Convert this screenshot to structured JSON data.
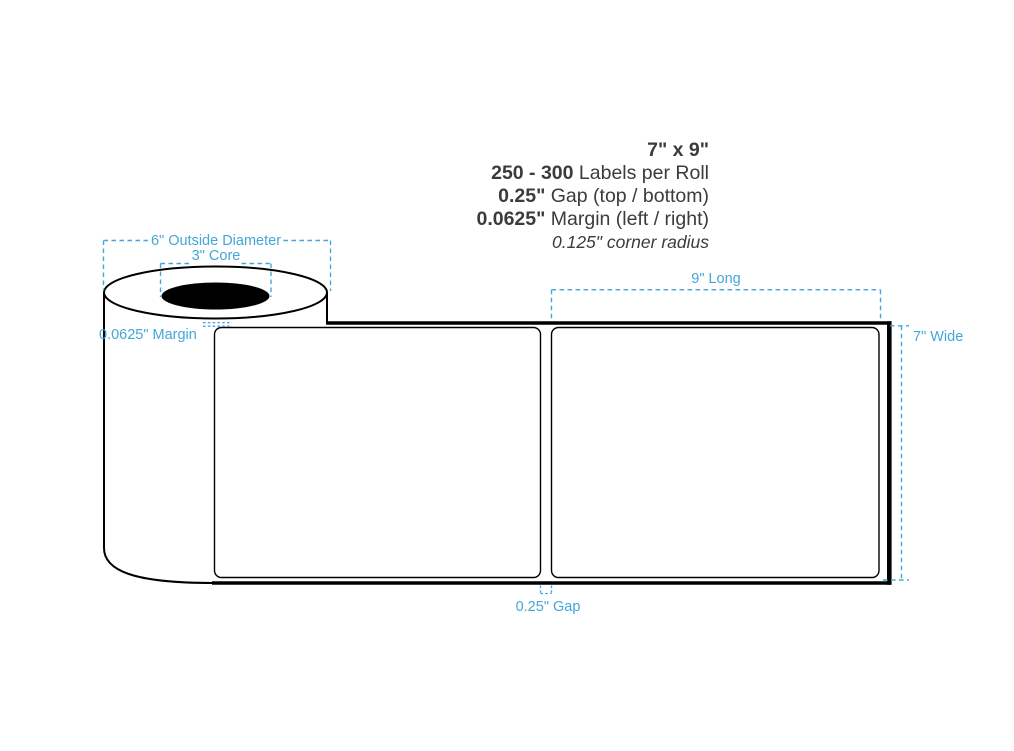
{
  "colors": {
    "annotation_blue": "#45a6d9",
    "ink": "#3b3b3b",
    "drawing_black": "#000000"
  },
  "spec": {
    "size_value": "7\" x 9\"",
    "count_value": "250 - 300",
    "count_label": " Labels per Roll",
    "gap_value": "0.25\"",
    "gap_label": " Gap (top / bottom)",
    "margin_value": "0.0625\"",
    "margin_label": " Margin (left / right)",
    "corner_note": "0.125\" corner radius"
  },
  "annotations": {
    "outside_diameter": "6\" Outside Diameter",
    "core": "3\" Core",
    "left_margin": "0.0625\" Margin",
    "length": "9\" Long",
    "width": "7\" Wide",
    "gap": "0.25\" Gap"
  }
}
